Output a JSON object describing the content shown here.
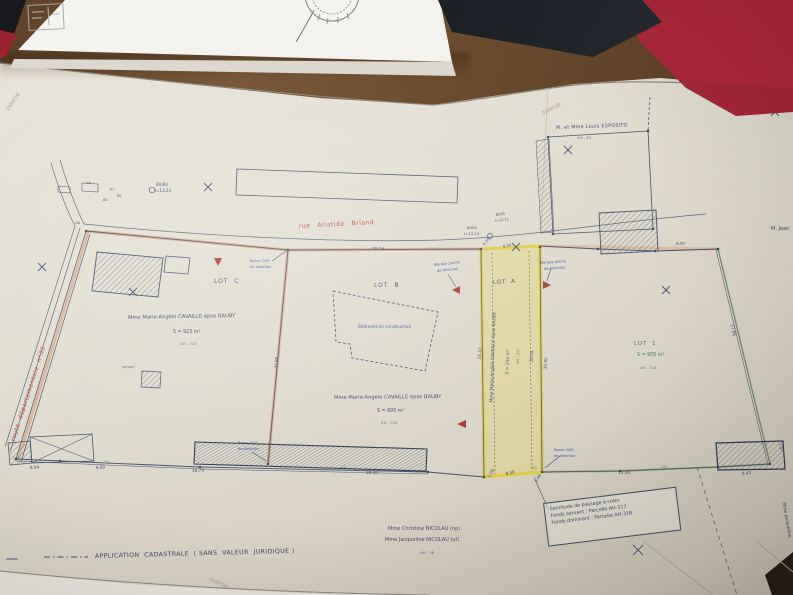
{
  "scene": {
    "desk_color": "#6b4a2c",
    "black_object_color": "#17191d",
    "red_object_color": "#9c2030",
    "sheet_color": "#e2ded2"
  },
  "plan": {
    "servitude_note": {
      "line1": "Servitude de passage à créer",
      "line2": "Fonds servant : Parcelle AH-317",
      "line3": "Fonds dominant : Parcelle AH-318"
    },
    "labels": [
      {
        "n": "plan-title",
        "t": "APPLICATION  CADASTRALE  ( SANS  VALEUR  JURIDIQUE )",
        "x": 95,
        "y": 553,
        "r": -1.5,
        "s": 6.2,
        "ls": 0.4
      },
      {
        "n": "street-name",
        "t": "rue   Aristide   Briand",
        "x": 299,
        "y": 224,
        "r": -3,
        "s": 6,
        "c": "red",
        "ls": 0.5
      },
      {
        "n": "road-name",
        "t": "route  départementale  n°30",
        "x": 14,
        "y": 438,
        "r": -72,
        "s": 6,
        "c": "red",
        "ls": 0.5
      },
      {
        "n": "benchmark-label",
        "t": "BV-BU",
        "x": 156,
        "y": 183,
        "s": 4
      },
      {
        "n": "benchmark-value",
        "t": "I=13.24",
        "x": 155,
        "y": 189,
        "s": 4
      },
      {
        "n": "point-label",
        "t": "86",
        "x": 103,
        "y": 198,
        "s": 3.5
      },
      {
        "n": "point-label",
        "t": "RE",
        "x": 117,
        "y": 194,
        "s": 3.5
      },
      {
        "n": "point-label",
        "t": "GA",
        "x": 86,
        "y": 181,
        "s": 3.5
      },
      {
        "n": "point-label",
        "t": "GA",
        "x": 75,
        "y": 221,
        "s": 3.5
      },
      {
        "n": "point-label",
        "t": "PT",
        "x": 110,
        "y": 188,
        "s": 3.5
      },
      {
        "n": "benchmark-label",
        "t": "BV85",
        "x": 467,
        "y": 226,
        "s": 3.8
      },
      {
        "n": "benchmark-value",
        "t": "I=13.15",
        "x": 464,
        "y": 232,
        "s": 3.8
      },
      {
        "n": "benchmark-label",
        "t": "BV85",
        "x": 496,
        "y": 213,
        "r": -8,
        "s": 3.5
      },
      {
        "n": "benchmark-value",
        "t": "I=13.11",
        "x": 495,
        "y": 219,
        "r": -8,
        "s": 3.5
      },
      {
        "n": "owner-esposito",
        "t": "M. et Mme Louis ESPOSITO",
        "x": 556,
        "y": 126,
        "r": -2,
        "s": 4.8,
        "ls": 0.3
      },
      {
        "n": "parcel-ref-esposito",
        "t": "AH - 45",
        "x": 577,
        "y": 136,
        "s": 3.8,
        "o": 0.8
      },
      {
        "n": "neighbor-right",
        "t": "M. Jean",
        "x": 771,
        "y": 227,
        "s": 5
      },
      {
        "n": "lot-c-title",
        "t": "LOT  C",
        "x": 214,
        "y": 279,
        "s": 6,
        "ls": 1
      },
      {
        "n": "lot-c-owner",
        "t": "Mme Marie-Angèle CAVAILLE épse BAUBY",
        "x": 128,
        "y": 316,
        "r": -1,
        "s": 5.2
      },
      {
        "n": "lot-c-area",
        "t": "S = 923 m²",
        "x": 173,
        "y": 330,
        "s": 4.8
      },
      {
        "n": "lot-c-ref",
        "t": "AH - 318",
        "x": 180,
        "y": 342,
        "s": 3.8,
        "o": 0.75
      },
      {
        "n": "garage-label",
        "t": "garage",
        "x": 122,
        "y": 365,
        "s": 3.6,
        "o": 0.8
      },
      {
        "n": "lot-b-title",
        "t": "LOT  B",
        "x": 374,
        "y": 283,
        "s": 6,
        "ls": 1
      },
      {
        "n": "building-label",
        "t": "Bâtiment en construction",
        "x": 358,
        "y": 325,
        "s": 4.2,
        "c": "blue"
      },
      {
        "n": "lot-b-owner",
        "t": "Mme Marie-Angèle CAVAILLE épse BAUBY",
        "x": 334,
        "y": 396,
        "r": -0.5,
        "s": 5.2
      },
      {
        "n": "lot-b-area",
        "t": "S = 895 m²",
        "x": 377,
        "y": 409,
        "s": 4.8
      },
      {
        "n": "lot-b-ref",
        "t": "AH - 318",
        "x": 381,
        "y": 421,
        "s": 3.8,
        "o": 0.75
      },
      {
        "n": "lot-a-title",
        "t": "LOT  A",
        "x": 493,
        "y": 280,
        "r": -3,
        "s": 5.5,
        "ls": 0.8
      },
      {
        "n": "lot-a-owner",
        "t": "Mme Marie-Angèle CAVAILLE épse BAUBY",
        "x": 492,
        "y": 400,
        "r": -88,
        "s": 4.4
      },
      {
        "n": "lot-a-area",
        "t": "S = 252 m²",
        "x": 508,
        "y": 372,
        "r": -88,
        "s": 4.4
      },
      {
        "n": "lot-a-ref",
        "t": "AH - 317",
        "x": 518,
        "y": 362,
        "r": -88,
        "s": 3.6,
        "o": 0.8
      },
      {
        "n": "lot-1-title",
        "t": "LOT  1",
        "x": 634,
        "y": 341,
        "s": 5.5,
        "c": "green",
        "ls": 0.8
      },
      {
        "n": "lot-1-area",
        "t": "S = 905 m²",
        "x": 637,
        "y": 353,
        "s": 4.8,
        "c": "green"
      },
      {
        "n": "lot-1-ref",
        "t": "AH - 316",
        "x": 640,
        "y": 366,
        "s": 3.8,
        "c": "green",
        "o": 0.85
      },
      {
        "n": "owner-nicolau-1",
        "t": "Mme Christine NICOLAU (np)",
        "x": 388,
        "y": 527,
        "s": 5,
        "c": "violet"
      },
      {
        "n": "owner-nicolau-2",
        "t": "Mme Jacqueline NICOLAU (uf)",
        "x": 385,
        "y": 538,
        "s": 5,
        "c": "violet"
      },
      {
        "n": "parcel-ref-nicolau",
        "t": "AH - 38",
        "x": 420,
        "y": 551,
        "s": 3.8,
        "c": "violet",
        "o": 0.8
      },
      {
        "n": "neighbor-bottom-right",
        "t": "Mme Jacqueline",
        "x": 783,
        "y": 500,
        "r": 80,
        "s": 4.5
      },
      {
        "n": "borne-label",
        "t": "Borne OGE",
        "x": 250,
        "y": 259,
        "s": 3.6,
        "c": "blue"
      },
      {
        "n": "borne-label",
        "t": "de direction",
        "x": 250,
        "y": 265,
        "s": 3.6,
        "c": "blue"
      },
      {
        "n": "borne-label",
        "t": "Borne OGE",
        "x": 238,
        "y": 441,
        "s": 3.6,
        "c": "blue"
      },
      {
        "n": "borne-label",
        "t": "de direction",
        "x": 238,
        "y": 447,
        "s": 3.6,
        "c": "blue"
      },
      {
        "n": "borne-label",
        "t": "Borne OGE",
        "x": 554,
        "y": 448,
        "s": 3.6,
        "c": "blue"
      },
      {
        "n": "borne-label",
        "t": "de direction",
        "x": 554,
        "y": 454,
        "s": 3.6,
        "c": "blue"
      },
      {
        "n": "marque-label",
        "t": "Marque peinte",
        "x": 434,
        "y": 263,
        "r": -6,
        "s": 3.6,
        "c": "blue"
      },
      {
        "n": "marque-label",
        "t": "de direction",
        "x": 437,
        "y": 269,
        "r": -6,
        "s": 3.6,
        "c": "blue"
      },
      {
        "n": "marque-label",
        "t": "Marque peinte",
        "x": 540,
        "y": 261,
        "r": -4,
        "s": 3.6,
        "c": "blue"
      },
      {
        "n": "marque-label",
        "t": "de direction",
        "x": 544,
        "y": 267,
        "r": -4,
        "s": 3.6,
        "c": "blue"
      },
      {
        "n": "dim",
        "t": "28.19",
        "x": 372,
        "y": 247,
        "r": 1,
        "s": 4.2
      },
      {
        "n": "dim",
        "t": "8.94",
        "x": 30,
        "y": 466,
        "r": -4,
        "s": 4.2
      },
      {
        "n": "dim",
        "t": "8.69",
        "x": 96,
        "y": 466,
        "r": -3,
        "s": 4.2
      },
      {
        "n": "dim",
        "t": "18.79",
        "x": 192,
        "y": 469,
        "r": -2,
        "s": 4.2
      },
      {
        "n": "dim",
        "t": "28.19",
        "x": 366,
        "y": 471,
        "r": 1,
        "s": 4.2
      },
      {
        "n": "dim",
        "t": "1.00",
        "x": 489,
        "y": 475,
        "r": -58,
        "s": 4
      },
      {
        "n": "dim",
        "t": "8.38",
        "x": 506,
        "y": 472,
        "r": -12,
        "s": 4
      },
      {
        "n": "dim",
        "t": "0.46",
        "x": 536,
        "y": 480,
        "r": -58,
        "s": 4
      },
      {
        "n": "dim",
        "t": "25.38",
        "x": 618,
        "y": 471,
        "r": -1,
        "s": 4.2
      },
      {
        "n": "dim",
        "t": "8.43",
        "x": 742,
        "y": 472,
        "r": -6,
        "s": 4.2
      },
      {
        "n": "dim",
        "t": "3.97",
        "x": 779,
        "y": 441,
        "r": 74,
        "s": 4
      },
      {
        "n": "dim",
        "t": "27.06",
        "x": 731,
        "y": 322,
        "r": 76,
        "s": 4.2
      },
      {
        "n": "dim",
        "t": "26.10",
        "x": 480,
        "y": 357,
        "r": -86,
        "s": 4.2
      },
      {
        "n": "dim",
        "t": "28.04",
        "x": 532,
        "y": 360,
        "r": -86,
        "s": 4.2
      },
      {
        "n": "dim",
        "t": "30.90",
        "x": 546,
        "y": 367,
        "r": -86,
        "s": 4.2
      },
      {
        "n": "dim",
        "t": "32.88",
        "x": 276,
        "y": 366,
        "r": -82,
        "s": 4
      },
      {
        "n": "dim",
        "t": "6.30",
        "x": 484,
        "y": 243,
        "r": -52,
        "s": 3.8
      },
      {
        "n": "dim",
        "t": "8.30",
        "x": 503,
        "y": 245,
        "r": -14,
        "s": 3.8
      },
      {
        "n": "dim",
        "t": "8.97",
        "x": 676,
        "y": 242,
        "r": 2,
        "s": 4.2
      },
      {
        "n": "point-number",
        "t": "114",
        "x": 13,
        "y": 457,
        "s": 3.2,
        "c": "green"
      },
      {
        "n": "point-number",
        "t": "113",
        "x": 103,
        "y": 461,
        "s": 3.2,
        "c": "green"
      },
      {
        "n": "point-number",
        "t": "112",
        "x": 340,
        "y": 466,
        "s": 3.2,
        "c": "green"
      },
      {
        "n": "point-number",
        "t": "111",
        "x": 531,
        "y": 467,
        "s": 3.2,
        "c": "green"
      },
      {
        "n": "point-number",
        "t": "110",
        "x": 661,
        "y": 466,
        "s": 3.2,
        "c": "green"
      },
      {
        "n": "sheet-number",
        "t": "2109776",
        "x": 8,
        "y": 108,
        "r": -55,
        "s": 4.5,
        "c": "faint"
      },
      {
        "n": "sheet-number",
        "t": "2109728",
        "x": 543,
        "y": 112,
        "r": -28,
        "s": 4.5,
        "c": "faint"
      },
      {
        "n": "sheet-number",
        "t": "2109776",
        "x": 745,
        "y": 100,
        "r": -48,
        "s": 4.5,
        "c": "faint"
      },
      {
        "n": "sheet-number",
        "t": "2109790",
        "x": 209,
        "y": 577,
        "r": 25,
        "s": 4.5,
        "c": "faint"
      }
    ]
  }
}
